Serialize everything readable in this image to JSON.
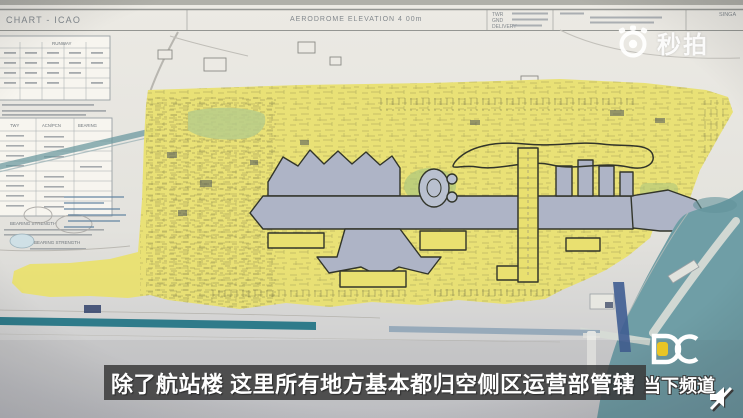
{
  "video": {
    "watermark": {
      "text": "秒拍",
      "icon": "miaopai-camera-icon"
    },
    "subtitle": {
      "text": "除了航站楼 这里所有地方基本都归空侧区运营部管辖",
      "bar_color": "#3a3a3a"
    },
    "channel": {
      "name": "当下频道",
      "logo": "DC",
      "accent_color": "#e9c525"
    },
    "muted": true
  },
  "chart": {
    "title_partial": "CHART - ICAO",
    "header": {
      "center_note": "AERODROME ELEVATION 4 00m",
      "freq_labels": {
        "row1": "TWR",
        "row2": "GND",
        "row3": "DELIVERY"
      },
      "far_right_partial": "SINGA"
    },
    "tables": {
      "runway_table_header": "RUNWAY",
      "twy_table_headers": {
        "col1": "TWY",
        "col2": "ACN/PCN",
        "col3": "BEARING"
      },
      "bearing_note_1": "BEARING STRENGTH",
      "bearing_note_2": "BEARING STRENGTH"
    },
    "colors": {
      "highlight_yellow": "#e9e070",
      "terminal_gray_blue": "#aeb4c6",
      "outline_dark": "#32352a",
      "sea_teal": "#6f9ea6",
      "runway_teal": "#2f7b8a",
      "paper": "#e6e5e0"
    }
  }
}
